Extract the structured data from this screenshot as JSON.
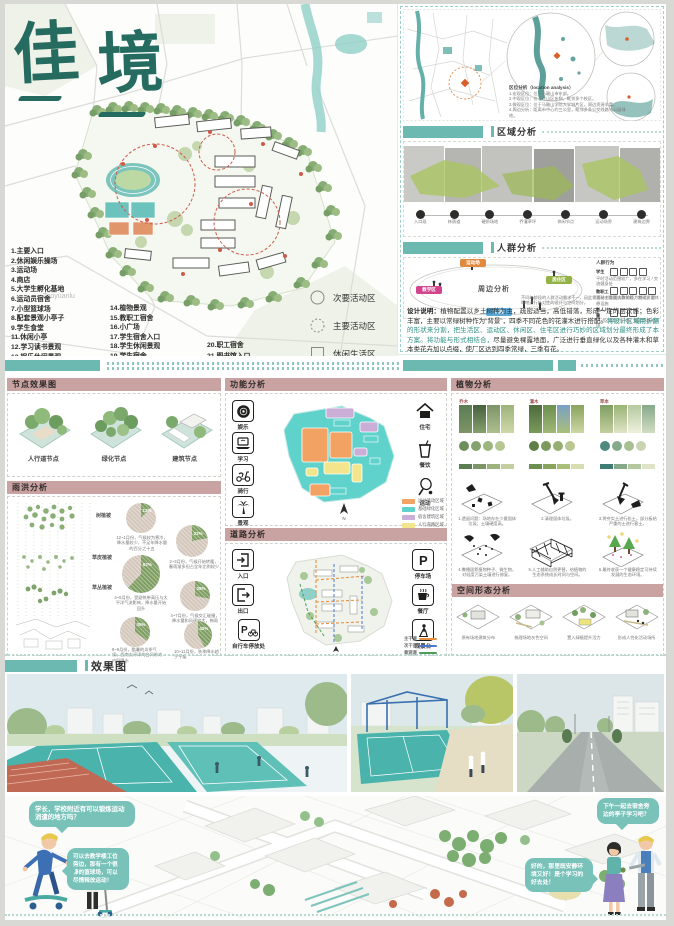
{
  "poster": {
    "title": "佳境",
    "title_char1": "佳",
    "title_char2": "境",
    "renders_header": "效果图"
  },
  "plan": {
    "street_label": "Taoyuanlu",
    "legend_col1": [
      "1.主要入口",
      "2.休闲娱乐操场",
      "3.运动场",
      "4.商店",
      "5.大学生孵化基地",
      "6.运动员宿舍",
      "7.小型篮球场",
      "8.配套景观小亭子",
      "9.学生食堂",
      "11.休闲小亭",
      "12.学习读书景观",
      "13.娱乐休闲景观"
    ],
    "legend_col2": [
      "14.植物景观",
      "15.教职工宿舍",
      "16.小广场",
      "17.学生宿舍入口",
      "18.学生休闲景观",
      "19.学生宿舍"
    ],
    "legend_col3": [
      "20.职工宿舍",
      "21.图书馆入口"
    ],
    "zones": [
      {
        "label": "次要活动区"
      },
      {
        "label": "主要活动区"
      },
      {
        "label": "休闲生活区"
      }
    ]
  },
  "right": {
    "location_title": "区位分析（location analysis）",
    "location_lines": [
      "1.宏观区位：位于马鞍山市东部。",
      "2.中观区位：位于花山区东侧，毗邻多个校区。",
      "3.微观区位：位于马鞍山学院大学城片区，周边资源丰富。",
      "4.周边分析：距离市中心约三公里，毗邻多条公交线路与公园绿地。"
    ],
    "region_header": "区域分析",
    "timeline": [
      "入口段",
      "林荫道",
      "硬质场地",
      "乔灌草坪",
      "休闲节点",
      "运动场旁",
      "建筑边界"
    ],
    "crowd_header": "人群分析",
    "bubble_title": "周边分析",
    "nodes": [
      {
        "label": "运动场",
        "color": "#e08a3e"
      },
      {
        "label": "居住区",
        "color": "#93b244"
      },
      {
        "label": "教学区",
        "color": "#d2448c"
      },
      {
        "label": "公园",
        "color": "#58a8d8"
      }
    ],
    "behavior_title": "人群行为",
    "behavior_rows": [
      {
        "who": "学生",
        "note": "平时活动范围较广，多在学习 / 交流健身处"
      },
      {
        "who": "教职工",
        "note": "活动主要围绕教学楼，期间需要休憩设施"
      },
      {
        "who": "老人儿童",
        "note": "活动区域较为分散，需要舒适的环境"
      }
    ],
    "behavior_foot": "不同年龄段的人群活动需求不一，因此需要针对各类人群的行为特点，对场地进行针对性的设计与空间划分。",
    "design_label": "设计说明：",
    "design_black1": "植物配置以乡土树种为主，疏密适当，高低错落，形成一定的层次感；色彩丰富，主要以常绿树种作为“背景”，四季不同花色的花灌木进行搭配。",
    "design_teal": "将设计区域用折翻的形状来分割，把生活区、运动区、休闲区、住宅区进行巧妙的区域划分最终形成了本方案。将功能与形式相结合，",
    "design_black2": "尽量避免裸露地面，广泛进行垂直绿化以及各种灌木和草本类花卉加以点缀，使厂区达到四季常绿，三季有花。"
  },
  "middle": {
    "nodes_header": "节点效果图",
    "chips": [
      "人行道节点",
      "绿化节点",
      "建筑节点"
    ],
    "rain_header": "雨洪分析",
    "layers": [
      "树植被",
      "草皮植被",
      "草丛植被"
    ],
    "pies": [
      {
        "pct": 12,
        "label": "12%",
        "caption": "12~1月份，气候较为寒冷，降水量较少，不足年降水量的百分之十五"
      },
      {
        "pct": 22,
        "label": "22%",
        "caption": "2~3月份，气候开始转暖，春雨渐多但占全年比例较少"
      },
      {
        "pct": 62,
        "label": "62%",
        "caption": "4~5月份，受副热带高压与太平洋气流影响，降水量开始回升"
      },
      {
        "pct": 28,
        "label": "28%",
        "caption": "4~7月份，气候交汇碰撞，降水量和风速较大，梅雨季节来临"
      },
      {
        "pct": 35,
        "label": "35%",
        "caption": "8~9月份，酷暑的炎季气候，西南太平洋的台风带来内陆降水"
      },
      {
        "pct": 42,
        "label": "42%",
        "caption": "10~11月份，秋季降水趋于平缓"
      }
    ],
    "function_header": "功能分析",
    "func_left": [
      {
        "label": "娱乐"
      },
      {
        "label": "学习"
      },
      {
        "label": "骑行"
      },
      {
        "label": "景观"
      }
    ],
    "func_right": [
      {
        "label": "住宅"
      },
      {
        "label": "餐饮"
      },
      {
        "label": "运动"
      }
    ],
    "func_legend": [
      {
        "color": "#f2a263",
        "label": "运动活动区域"
      },
      {
        "color": "#5ed2cb",
        "label": "基础绿化区域"
      },
      {
        "color": "#cbaed8",
        "label": "宿舍建筑区域"
      },
      {
        "color": "#f2e58b",
        "label": "人行道路区域"
      }
    ],
    "north": "N",
    "road_header": "道路分析",
    "road_left": [
      {
        "label": "入口"
      },
      {
        "label": "出口"
      },
      {
        "label": "自行车停放处"
      }
    ],
    "road_right": [
      {
        "label": "停车场"
      },
      {
        "label": "餐厅"
      },
      {
        "label": "观景台"
      }
    ],
    "road_legend": [
      {
        "color": "#e8903f",
        "label": "主干道"
      },
      {
        "color": "#4a78d0",
        "label": "次干道"
      },
      {
        "color": "#4f9e57",
        "label": "景观道"
      }
    ],
    "plants_header": "植物分析",
    "plant_groups": [
      {
        "label": "乔木",
        "swatches": [
          "#5a7d52",
          "#7d9468",
          "#9db37c",
          "#c3cf9e"
        ]
      },
      {
        "label": "灌木",
        "swatches": [
          "#6b8f4e",
          "#8aa35f",
          "#a9bf79",
          "#d7ddb0"
        ]
      },
      {
        "label": "草本",
        "swatches": [
          "#3f7d74",
          "#86a98a",
          "#b5c9a0",
          "#dfe3c8"
        ]
      }
    ],
    "steps": [
      "1.遗留问题：场地存在少量固体垃圾；土壤硬度高。",
      "2.清理固体垃圾。",
      "3.将夯实土进行松土，部分板结严重的土进行客土。",
      "4.撒播固氮植物种子、微生物，对轻度污染土壤进行修复。",
      "5.人工辅助自然更替，给植物的生态系统成长时间与空间。",
      "6.最终收获一个健康稳定可持续发展的生态环境。"
    ],
    "form_header": "空间形态分析",
    "form_captions": [
      "原有场地建筑分布",
      "梳理场地灰色空间",
      "置入绿植提升活力",
      "形成人性化活动场所"
    ]
  },
  "axon": {
    "bubbles": [
      "学长，学校附近有可以锻炼运动消遣的地方吗？",
      "可以去教学楼工位旁边，那有一个很棒的篮球场，可以尽情释放运动！",
      "下午一起去宿舍旁边的亭子学习吧？",
      "好的，那里既安静环境又好！是个学习的好去处！"
    ]
  },
  "colors": {
    "teal": "#5fb3ab",
    "teal_dark": "#256b60",
    "pink": "#c9a2a2",
    "bubble": "#79c2ba",
    "pie_green": "#7f9e62",
    "pie_rest": "#d4c7bb"
  }
}
